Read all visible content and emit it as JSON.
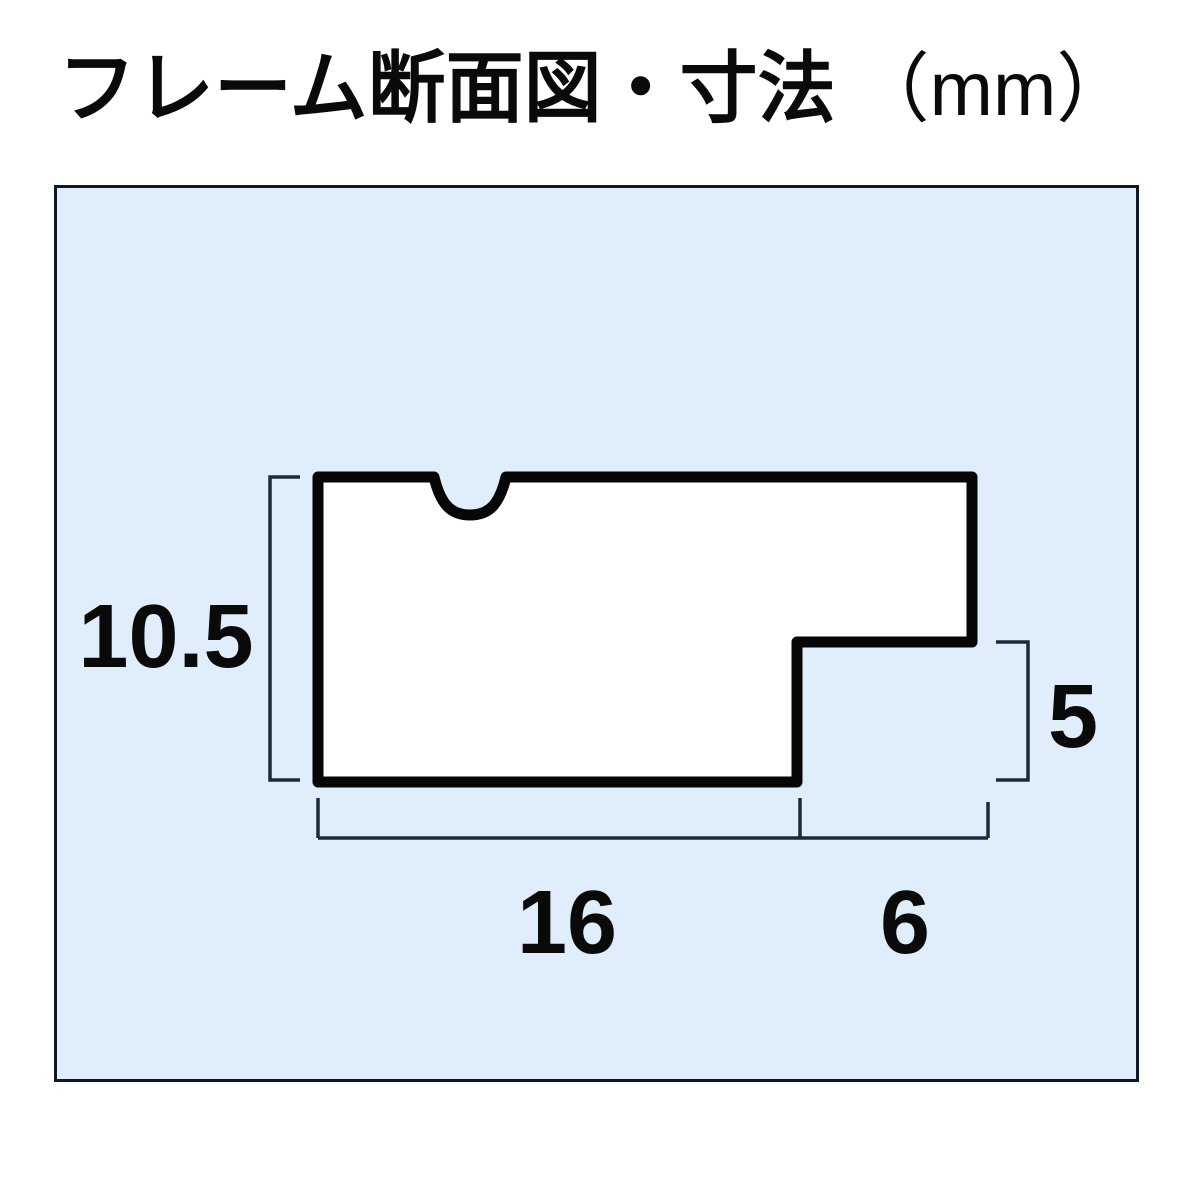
{
  "title": {
    "text": "フレーム断面図・寸法",
    "unit": "（mm）"
  },
  "panel": {
    "background_color": "#dfeefa",
    "border_color": "#0d1926"
  },
  "profile": {
    "description": "picture-frame cross-section profile with top notch and bottom-right rabbet step",
    "fill_color": "#ffffff",
    "stroke_color": "#060606"
  },
  "dimension_line_color": "#1b2a38",
  "dimensions": {
    "height": {
      "label": "10.5",
      "edge": "left overall height"
    },
    "rabbet_height": {
      "label": "5",
      "edge": "right step height"
    },
    "width": {
      "label": "16",
      "edge": "bottom main width"
    },
    "rabbet_width": {
      "label": "6",
      "edge": "bottom rabbet width"
    }
  }
}
